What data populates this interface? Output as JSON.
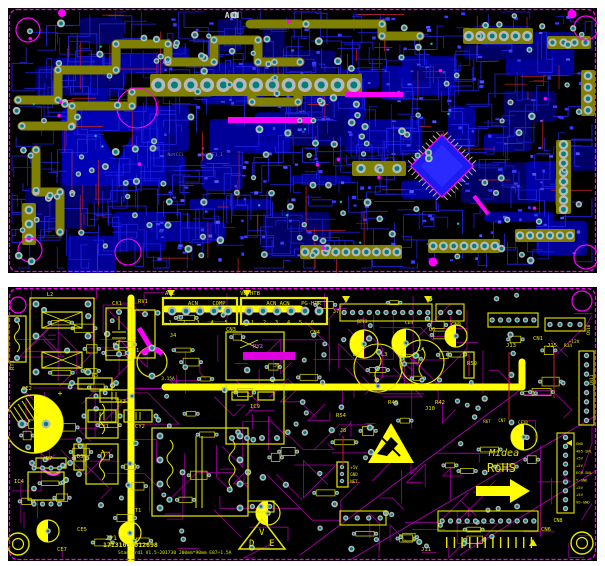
{
  "colors": {
    "page_bg": "#ffffff",
    "board_bg": "#000000",
    "outline_magenta": "#ff00ff",
    "copper_blue": "#2222ee",
    "copper_blue_dark": "#0000a8",
    "olive": "#7f7f00",
    "pad_ring": "#b8b8b8",
    "pad_center": "#007f7f",
    "silk_yellow": "#e8e800",
    "silk_bright": "#ffff00",
    "trace_magenta": "#a000a0",
    "red": "#cc2222",
    "cyan": "#00c8c8"
  },
  "top_board": {
    "labels": [
      {
        "t": "ACN",
        "x": 232,
        "y": 18,
        "c": "#d8d8d8",
        "s": 8,
        "b": true
      },
      {
        "t": "ACL",
        "x": 167,
        "y": 64,
        "c": "#9a9ae0",
        "s": 5
      },
      {
        "t": "NetCE1_",
        "x": 177,
        "y": 156,
        "c": "#6f6fff",
        "s": 4.5
      },
      {
        "t": "NetCE1_1",
        "x": 212,
        "y": 156,
        "c": "#6f6fff",
        "s": 4.5
      }
    ]
  },
  "bottom_board": {
    "brand": "Midea",
    "rohs": "RoHS",
    "vde_letters": [
      "V",
      "D",
      "E"
    ],
    "id_line1": "17131000012698",
    "id_line2": "Standard1  V1.5-201730   200mm*90mm   E87+1.5A",
    "cn8_pins": [
      "GND",
      "485-SNL",
      "+5V",
      "+5V",
      "ECM-SNL",
      "Y-GND",
      "+5V",
      "+5V",
      "VO-GND"
    ],
    "labels": [
      {
        "t": "L2",
        "x": 50,
        "y": 296
      },
      {
        "t": "CX1",
        "x": 117,
        "y": 305
      },
      {
        "t": "RV1",
        "x": 143,
        "y": 303
      },
      {
        "t": "ACL",
        "x": 170,
        "y": 295
      },
      {
        "t": "ACN",
        "x": 193,
        "y": 305
      },
      {
        "t": "COMP",
        "x": 219,
        "y": 305
      },
      {
        "t": "VB-HTB",
        "x": 250,
        "y": 295
      },
      {
        "t": "ACN ACN",
        "x": 278,
        "y": 305
      },
      {
        "t": "PG-HTR",
        "x": 311,
        "y": 305
      },
      {
        "t": "1  2  3  4  5",
        "x": 200,
        "y": 324,
        "s": 5,
        "ls": 4
      },
      {
        "t": "1  2  3  4  5  6",
        "x": 284,
        "y": 324,
        "s": 5,
        "ls": 3
      },
      {
        "t": "CN4",
        "x": 315,
        "y": 334
      },
      {
        "t": "CN3",
        "x": 231,
        "y": 331
      },
      {
        "t": "J4",
        "x": 173,
        "y": 337
      },
      {
        "t": "F1",
        "x": 136,
        "y": 352
      },
      {
        "t": "3.15A",
        "x": 168,
        "y": 380,
        "s": 4.5
      },
      {
        "t": "RT1",
        "x": 14,
        "y": 365,
        "r": -90
      },
      {
        "t": "R5",
        "x": 95,
        "y": 377
      },
      {
        "t": "CY3",
        "x": 121,
        "y": 403
      },
      {
        "t": "CY1",
        "x": 104,
        "y": 428
      },
      {
        "t": "CY2",
        "x": 140,
        "y": 428
      },
      {
        "t": "CE2",
        "x": 27,
        "y": 390
      },
      {
        "t": "+",
        "x": 60,
        "y": 396,
        "s": 8
      },
      {
        "t": "R7",
        "x": 49,
        "y": 460
      },
      {
        "t": "IC4",
        "x": 19,
        "y": 483
      },
      {
        "t": "D3",
        "x": 80,
        "y": 458
      },
      {
        "t": "T1",
        "x": 138,
        "y": 512
      },
      {
        "t": "JP1",
        "x": 111,
        "y": 540,
        "s": 6.5
      },
      {
        "t": "CE5",
        "x": 82,
        "y": 531
      },
      {
        "t": "CE7",
        "x": 62,
        "y": 551
      },
      {
        "t": "RY2",
        "x": 258,
        "y": 348,
        "c": "#ff66ff"
      },
      {
        "t": "IC9",
        "x": 255,
        "y": 408
      },
      {
        "t": "J5",
        "x": 277,
        "y": 367
      },
      {
        "t": "J7",
        "x": 336,
        "y": 313
      },
      {
        "t": "CE13",
        "x": 362,
        "y": 323,
        "s": 4.5
      },
      {
        "t": "CE4",
        "x": 409,
        "y": 324,
        "s": 4.5
      },
      {
        "t": "Q6",
        "x": 432,
        "y": 331
      },
      {
        "t": "L3",
        "x": 384,
        "y": 356
      },
      {
        "t": "L4",
        "x": 421,
        "y": 351
      },
      {
        "t": "D6",
        "x": 356,
        "y": 356
      },
      {
        "t": "R59",
        "x": 472,
        "y": 365
      },
      {
        "t": "CN9",
        "x": 456,
        "y": 326
      },
      {
        "t": "J13",
        "x": 511,
        "y": 347
      },
      {
        "t": "J15",
        "x": 552,
        "y": 347
      },
      {
        "t": "R34",
        "x": 568,
        "y": 347,
        "s": 4.5
      },
      {
        "t": "CN1",
        "x": 538,
        "y": 340
      },
      {
        "t": "+12V",
        "x": 574,
        "y": 343,
        "s": 4.5
      },
      {
        "t": "CN10",
        "x": 590,
        "y": 330,
        "r": -90,
        "s": 4.5
      },
      {
        "t": "CN11",
        "x": 593,
        "y": 380,
        "r": -90,
        "s": 4.5
      },
      {
        "t": "R54",
        "x": 341,
        "y": 417
      },
      {
        "t": "J8",
        "x": 343,
        "y": 432
      },
      {
        "t": "R40",
        "x": 393,
        "y": 404
      },
      {
        "t": "R42",
        "x": 440,
        "y": 404
      },
      {
        "t": "J10",
        "x": 430,
        "y": 410
      },
      {
        "t": "+5V",
        "x": 354,
        "y": 469,
        "s": 4
      },
      {
        "t": "GND",
        "x": 354,
        "y": 476,
        "s": 4
      },
      {
        "t": "NET",
        "x": 354,
        "y": 483,
        "s": 4
      },
      {
        "t": "R67",
        "x": 487,
        "y": 423,
        "s": 4
      },
      {
        "t": "CN7",
        "x": 502,
        "y": 422,
        "s": 4
      },
      {
        "t": "CE10",
        "x": 523,
        "y": 424,
        "s": 4
      },
      {
        "t": "CN8",
        "x": 558,
        "y": 522,
        "s": 5
      },
      {
        "t": "CN6",
        "x": 546,
        "y": 531
      },
      {
        "t": "J11",
        "x": 426,
        "y": 551
      }
    ]
  }
}
